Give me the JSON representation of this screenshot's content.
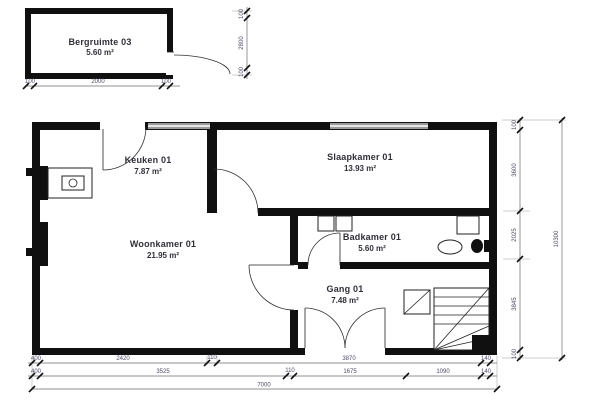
{
  "storage": {
    "name": "Bergruimte 03",
    "area": "5.60 m²",
    "dim_bottom": [
      "100",
      "2000",
      "100"
    ],
    "dim_right": [
      "100",
      "2800",
      "100"
    ]
  },
  "rooms": {
    "keuken": {
      "name": "Keuken 01",
      "area": "7.87 m²"
    },
    "slaapkamer": {
      "name": "Slaapkamer 01",
      "area": "13.93 m²"
    },
    "woonkamer": {
      "name": "Woonkamer 01",
      "area": "21.95 m²"
    },
    "badkamer": {
      "name": "Badkamer 01",
      "area": "5.60 m²"
    },
    "gang": {
      "name": "Gang 01",
      "area": "7.48 m²"
    }
  },
  "dims": {
    "bottom_row1": [
      "400",
      "2420",
      "110",
      "3870",
      "140"
    ],
    "bottom_row2": [
      "400",
      "3525",
      "110",
      "1675",
      "1090",
      "140"
    ],
    "bottom_total": "7000",
    "right_chain": [
      "100",
      "3600",
      "2025",
      "3845",
      "100"
    ],
    "right_total": "10300"
  },
  "colors": {
    "wall": "#101010",
    "window": "#9a9a9a",
    "dimension_text": "#4a4a6a",
    "label_text": "#2f2f3a"
  }
}
